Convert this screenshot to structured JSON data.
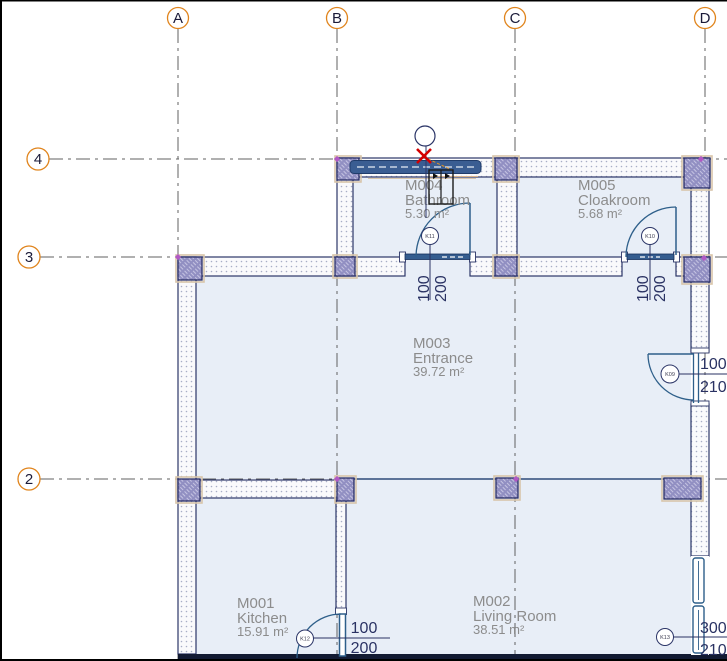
{
  "grid": {
    "columns": [
      "A",
      "B",
      "C",
      "D"
    ],
    "rows": [
      "4",
      "3",
      "2"
    ]
  },
  "rooms": [
    {
      "code": "M001",
      "name": "Kitchen",
      "area": "15.91 m²"
    },
    {
      "code": "M002",
      "name": "Living Room",
      "area": "38.51 m²"
    },
    {
      "code": "M003",
      "name": "Entrance",
      "area": "39.72 m²"
    },
    {
      "code": "M004",
      "name": "Bathroom",
      "area": "5.30 m²"
    },
    {
      "code": "M005",
      "name": "Cloakroom",
      "area": "5.68 m²"
    }
  ],
  "doors": [
    {
      "tag": "K11",
      "width": "100",
      "height": "200"
    },
    {
      "tag": "K10",
      "width": "100",
      "height": "200"
    },
    {
      "tag": "K09",
      "width": "100",
      "height": "210"
    },
    {
      "tag": "K12",
      "width": "100",
      "height": "200"
    },
    {
      "tag": "K13",
      "width": "300",
      "height": "210"
    }
  ],
  "colors": {
    "room_fill": "#e8eef7",
    "wall_line": "#2c3668",
    "column_fill": "#918fc2",
    "grid_bubble": "#e0841c",
    "door_swing": "#2e5f8a",
    "room_label": "#8c8c8c",
    "dimension_text": "#2a3263",
    "cursor": "#d40000"
  }
}
